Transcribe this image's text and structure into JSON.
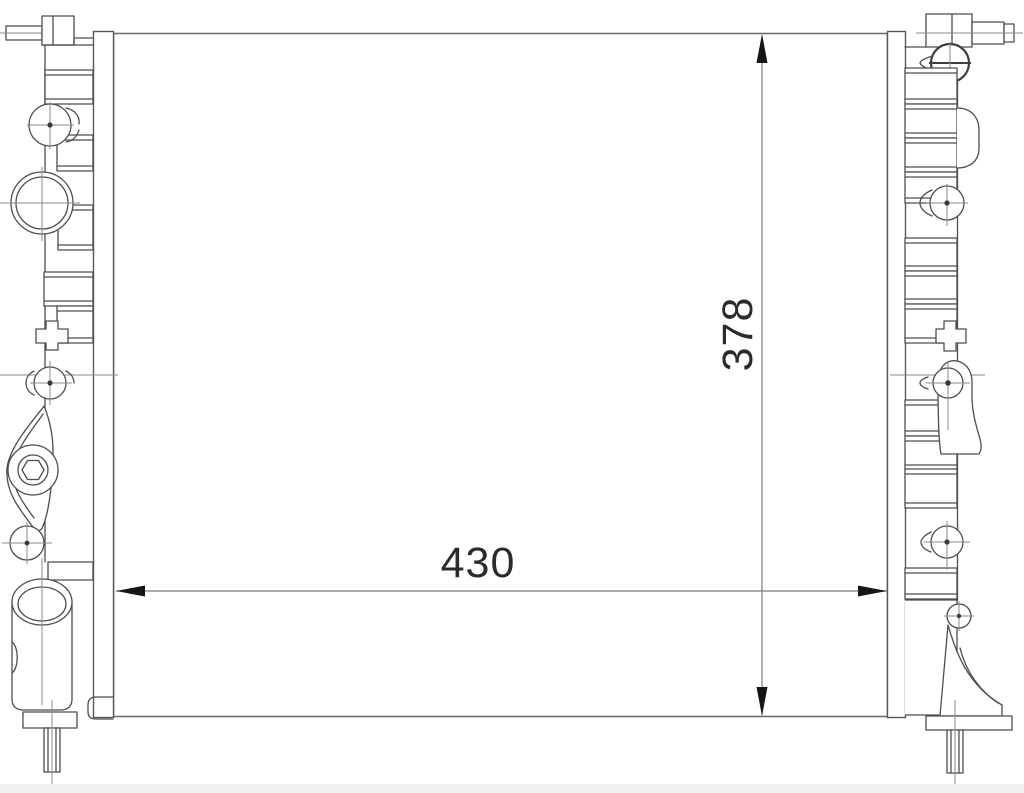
{
  "dimension_labels": {
    "width": "430",
    "height": "378"
  },
  "style": {
    "line_color": "#4d4d4d",
    "thin_centerline_color": "#8a8a8a",
    "core_outline_color": "#6f6f6f",
    "dimension_arrow_color": "#161616",
    "dimension_text_color": "#2b2b2b",
    "background": "#ffffff",
    "footer_band": "#eef0f1"
  }
}
